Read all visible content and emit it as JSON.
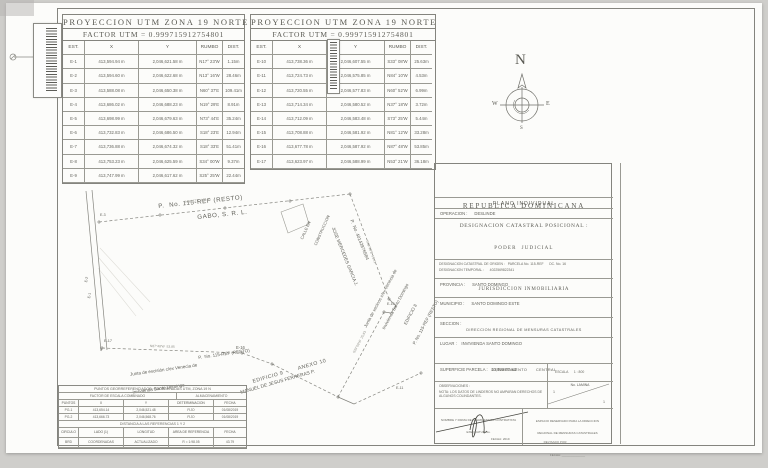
{
  "table1": {
    "title": "PROYECCION UTM ZONA 19 NORTE",
    "factor": "FACTOR UTM = 0.999715912754801",
    "columns": [
      "EST.",
      "X",
      "Y",
      "RUMBO",
      "DIST."
    ],
    "rows": [
      [
        "E-1",
        "413,594.94 m",
        "2,046,621.58 m",
        "N17° 23'W",
        "1.15m"
      ],
      [
        "E-2",
        "413,594.60 m",
        "2,046,622.68 m",
        "N13° 16'W",
        "28.46m"
      ],
      [
        "E-3",
        "413,588.08 m",
        "2,046,650.38 m",
        "N60° 37'E",
        "109.41m"
      ],
      [
        "E-4",
        "413,686.02 m",
        "2,046,688.23 m",
        "N19° 29'E",
        "8.91m"
      ],
      [
        "E-5",
        "413,698.99 m",
        "2,046,679.63 m",
        "N73° 44'E",
        "35.24m"
      ],
      [
        "E-6",
        "413,732.83 m",
        "2,046,686.50 m",
        "S18° 23'E",
        "12.94m"
      ],
      [
        "E-7",
        "413,736.88 m",
        "2,046,674.32 m",
        "S18° 33'E",
        "51.41m"
      ],
      [
        "E-8",
        "413,753.23 m",
        "2,046,625.59 m",
        "S34° 00'W",
        "9.37m"
      ],
      [
        "E-9",
        "413,747.99 m",
        "2,046,617.62 m",
        "S25° 25'W",
        "22.44m"
      ]
    ]
  },
  "table2": {
    "title": "PROYECCION UTM ZONA 19 NORTE",
    "factor": "FACTOR UTM = 0.999715912754801",
    "columns": [
      "EST.",
      "X",
      "Y",
      "RUMBO",
      "DIST."
    ],
    "rows": [
      [
        "E-10",
        "413,738.36 m",
        "2,046,607.55 m",
        "S33° 08'W",
        "25.63m"
      ],
      [
        "E-11",
        "413,724.73 m",
        "2,046,575.85 m",
        "N84° 10'W",
        "4.53m"
      ],
      [
        "E-12",
        "413,720.55 m",
        "2,046,577.83 m",
        "N60° 52'W",
        "6.99m"
      ],
      [
        "E-13",
        "413,714.34 m",
        "2,046,580.52 m",
        "N37° 18'W",
        "3.72m"
      ],
      [
        "E-14",
        "413,712.09 m",
        "2,046,583.48 m",
        "S73° 25'W",
        "5.44m"
      ],
      [
        "E-15",
        "413,708.88 m",
        "2,046,581.92 m",
        "N81° 12'W",
        "33.28m"
      ],
      [
        "E-16",
        "413,677.78 m",
        "2,046,587.92 m",
        "N87° 48'W",
        "53.85m"
      ],
      [
        "E-17",
        "413,623.97 m",
        "2,046,588.99 m",
        "N53° 21'W",
        "36.18m"
      ]
    ]
  },
  "compass": {
    "north": "N",
    "west": "W",
    "east": "E",
    "south": "S"
  },
  "plot": {
    "owner_line1": "P.  No. 115-REF (RESTO)",
    "owner_line2": "GABO, S. R. L.",
    "calle_line1": "CALLE EN",
    "calle_line2": "CONSTRUCCION",
    "jose_line1": "P.  No. 40142876584",
    "jose_line2": "JOSE MERCEDES GARCIA J.",
    "junta_right_1": "Junta de vecinos c/ex Venecia de",
    "junta_right_2": "Invivienda Santo Domingo",
    "junta_right_3": "EDIFICIO 8",
    "junta_right_4": "P. No. 115-REF (RESTO)",
    "junta_bottom_1": "Junta de escisión c/ex Venecia de",
    "junta_bottom_2": "Invivienda Santo Domingo",
    "p115_bottom": "P.  No. 115-REF (RESTO)",
    "edificio": "EDIFICIO 9        ANEXO 10",
    "manuel": "MANUEL DE JESUS FERRERAS P.",
    "courses": {
      "c1": "N60°37'E  109.41",
      "c2": "S18°33'E  51.41",
      "c3": "S33°08'W  25.63",
      "c4": "N87°48'W  53.85"
    },
    "stations": {
      "e1": "E-1",
      "e2": "E-2",
      "e3": "E-3",
      "e10": "E-10",
      "e11": "E-11",
      "e16": "E-16",
      "e17": "E-17"
    }
  },
  "ref_table": {
    "title": "PUNTOS GEORREFERENCIADOS: COORDENADAS UTM, ZONA 19 N",
    "subtitle_left": "FACTOR DE ESCALA COMBINADO",
    "subtitle_right": "ALMACENAMIENTO",
    "columns": [
      "PUNTOS",
      "X",
      "Y",
      "DETERMINACION",
      "FECHA"
    ],
    "rows": [
      [
        "PG-1",
        "413,654.14",
        "2,046,521.48",
        "FIJO",
        "01/08/2019"
      ],
      [
        "PG-2",
        "413,666.73",
        "2,046,568.76",
        "FIJO",
        "01/08/2019"
      ]
    ],
    "band": "DISTANCIA A LAS REFERENCIAS 1 Y 2",
    "columns2": [
      "CIRCULO",
      "LADO (1)",
      "LONGITUD",
      "AREA DE REFERENCIA",
      "FECHA"
    ],
    "rows2": [
      [
        "BRD",
        "COORDENADAS",
        "ACTUALIZADO",
        "R = 1:98.05",
        "43.79"
      ]
    ]
  },
  "title_block": {
    "header1": "REPUBLICA DOMINICANA",
    "header2": "PODER  JUDICIAL",
    "header3": "JURISDICCION INMOBILIARIA",
    "header4": "DIRECCION REGIONAL DE MENSURAS CATASTRALES",
    "header5": "DEPARTAMENTO      CENTRAL",
    "plano": "PLANO INDIVIDUAL",
    "operacion": "OPERACION :      DESLINDE",
    "designacion_title": "DESIGNACION CATASTRAL POSICIONAL :",
    "origen": "DESIGNACION CATASTRAL DE ORIGEN :   PARCELA No. 115-REF      DC. No. 16",
    "temporal": "DESIGNACION TEMPORAL :      4022569822341",
    "provincia": "PROVINCIA :      SANTO DOMINGO",
    "municipio": "MUNICIPIO :      SANTO DOMINGO ESTE",
    "seccion": "SECCION :",
    "lugar": "LUGAR :    INVIVIENDA SANTO DOMINGO",
    "superficie": "SUPERFICIE PARCELA :   10,029.97 m2",
    "escala": "ESCALA      1 : 800",
    "observaciones": "OBSERVACIONES :",
    "nota": "NOTA: LOS DATOS DE LINDEROS NO AMPARAN DERECHOS DE ALGUNOS COLINDANTES.",
    "lamina_label": "No. LAMINA",
    "lamina_top": "1",
    "lamina_bottom": "1",
    "firma_header1": "NOMBRE Y FIRMA DEL AGRIMENSOR CONTRATISTA",
    "firma_header2": "EXEQUATUR No.",
    "firma_fecha": "FECHA: 2019",
    "revisado_header1": "ESPACIO RESERVADO PARA LA DIRECCION",
    "revisado_header2": "REGIONAL DE MENSURAS CATASTRALES",
    "revisado_line1": "REVISADO POR: ______________",
    "revisado_line2": "FECHA: ______________"
  }
}
